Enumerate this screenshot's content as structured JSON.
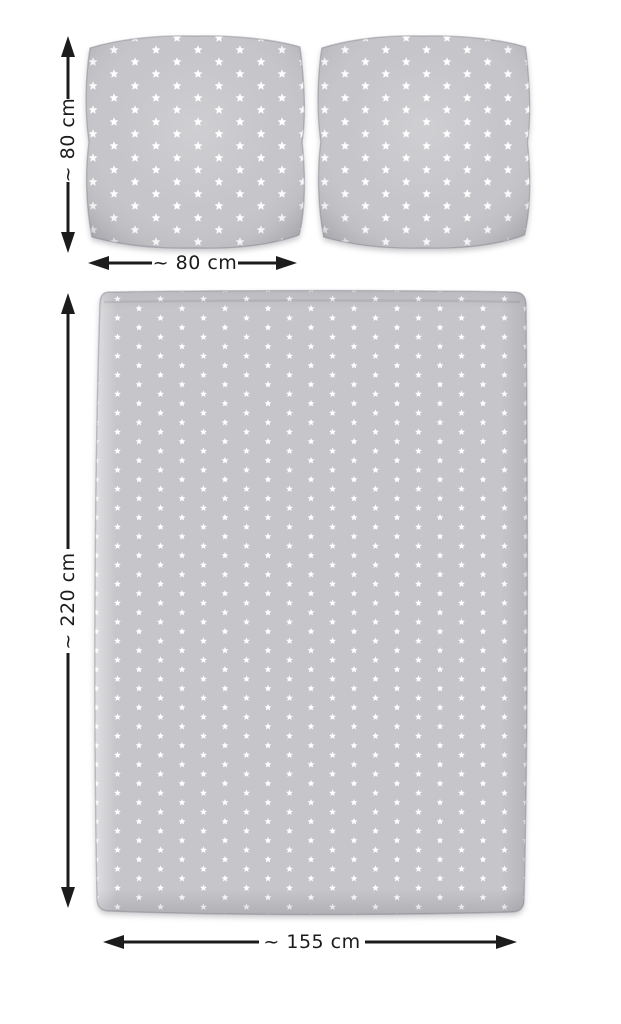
{
  "page": {
    "background_color": "#ffffff"
  },
  "colors": {
    "page_background": "#ffffff",
    "fabric": "#c6c6ca",
    "star": "#ffffff",
    "arrow": "#1c1c1c",
    "label_text": "#1b1b1b"
  },
  "pillows": {
    "count": 2,
    "height_label": "~ 80 cm",
    "width_label": "~ 80 cm"
  },
  "duvet": {
    "height_label": "~ 220 cm",
    "width_label": "~ 155 cm"
  }
}
